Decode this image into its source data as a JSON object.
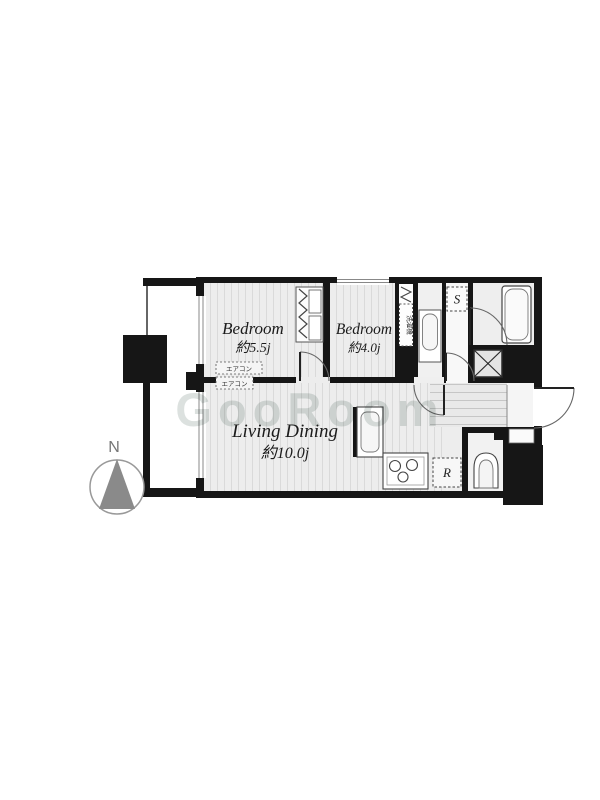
{
  "page": {
    "background": "#ffffff"
  },
  "floorplan": {
    "watermark": "GooRoom",
    "compass": {
      "north": "N"
    },
    "rooms": {
      "bedroom1": {
        "name": "Bedroom",
        "size": "約5.5j"
      },
      "bedroom2": {
        "name": "Bedroom",
        "size": "約4.0j"
      },
      "living": {
        "name": "Living Dining",
        "size": "約10.0j"
      }
    },
    "fixtures": {
      "storage": "S",
      "refrigerator": "R",
      "washer": "洗濯機",
      "aircon": "エアコン"
    },
    "colors": {
      "wall": "#161616",
      "floor": "#ededed",
      "floor_stripe": "#dadada",
      "entrance_stripe": "#c6c6c6",
      "fixture_stroke": "#555555",
      "compass_gray": "#8a8a8a",
      "watermark": "#b9c4c0"
    }
  }
}
